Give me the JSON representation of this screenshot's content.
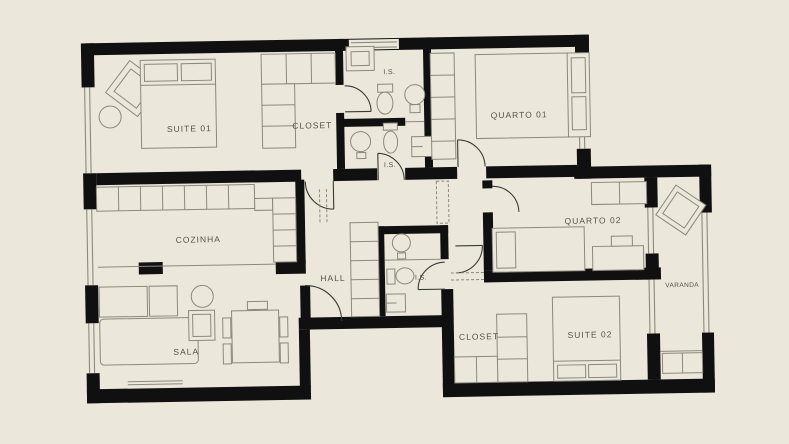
{
  "plan": {
    "type": "apartment-floor-plan",
    "rooms": {
      "suite01": {
        "label": "SUITE  01"
      },
      "closet01": {
        "label": "CLOSET"
      },
      "is01": {
        "label": "I.S."
      },
      "is02": {
        "label": "I.S."
      },
      "quarto01": {
        "label": "QUARTO  01"
      },
      "cozinha": {
        "label": "COZINHA"
      },
      "hall": {
        "label": "HALL"
      },
      "is03": {
        "label": "I.S."
      },
      "quarto02": {
        "label": "QUARTO  02"
      },
      "varanda": {
        "label": "VARANDA"
      },
      "sala": {
        "label": "SALA"
      },
      "closet02": {
        "label": "CLOSET"
      },
      "suite02": {
        "label": "SUITE  02"
      }
    },
    "colors": {
      "background": "#ebe8db",
      "wall": "#101010",
      "furniture_line": "#8b887d",
      "door_line": "#3a3a35",
      "label_text": "#55524a"
    }
  }
}
